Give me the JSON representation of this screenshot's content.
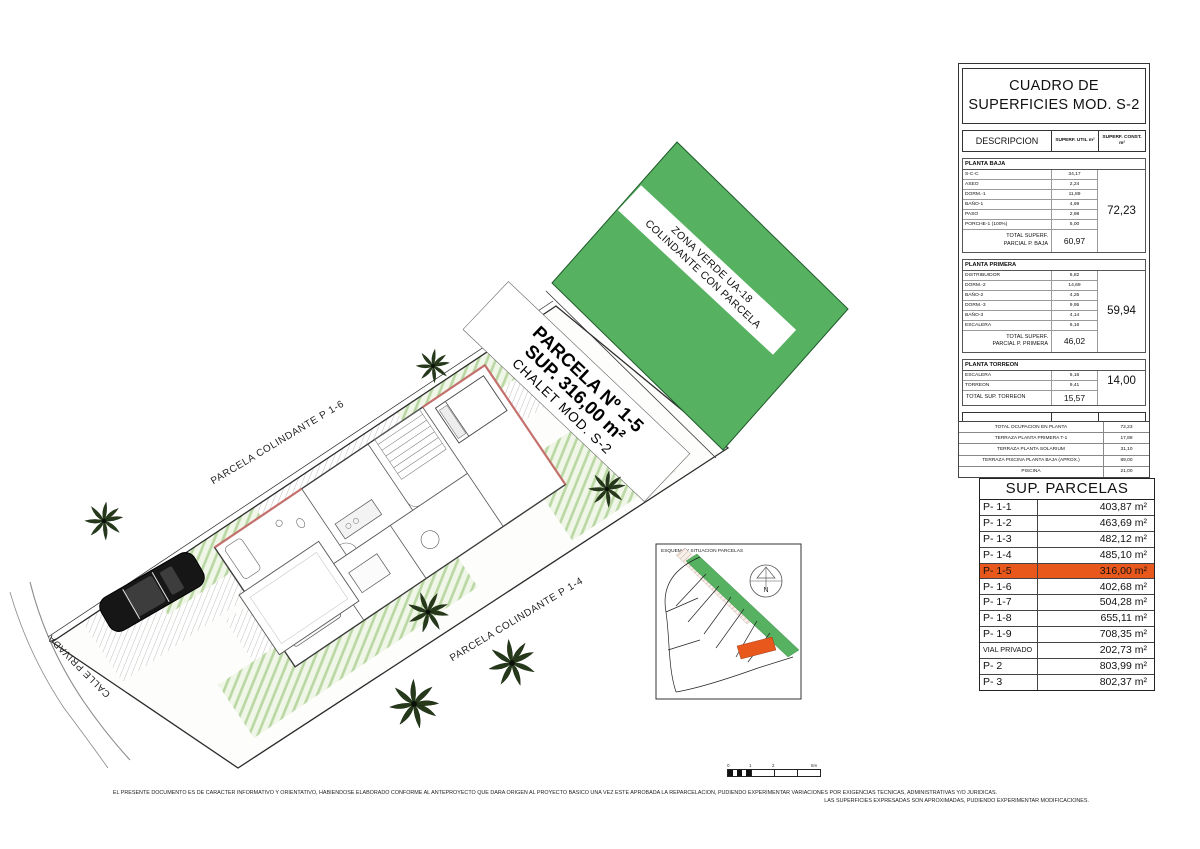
{
  "colors": {
    "green": "#56b161",
    "orange": "#e8571c",
    "lawn_stripe": "#b9d7a2",
    "hatch_gray": "#9c9c95"
  },
  "cuadro": {
    "title": "CUADRO DE SUPERFICIES MOD. S-2",
    "headers": {
      "desc": "DESCRIPCION",
      "util": "SUPERF. UTIL m²",
      "const": "SUPERF. CONST. m²"
    },
    "sections": [
      {
        "name": "PLANTA BAJA",
        "rows": [
          [
            "S-C-C",
            "34,17"
          ],
          [
            "ASEO",
            "2,24"
          ],
          [
            "DORM.-1",
            "11,89"
          ],
          [
            "BAÑO-1",
            "4,69"
          ],
          [
            "PASO",
            "2,98"
          ],
          [
            "PORCHE-1 (100%)",
            "5,00"
          ]
        ],
        "total_label": "TOTAL SUPERF.\nPARCIAL P. BAJA",
        "total": "60,97",
        "const_total": "72,23",
        "const_span": "all",
        "two_line": true
      },
      {
        "name": "PLANTA PRIMERA",
        "rows": [
          [
            "DISTRIBUIDOR",
            "6,82"
          ],
          [
            "DORM.-2",
            "14,69"
          ],
          [
            "BAÑO-2",
            "4,26"
          ],
          [
            "DORM.-3",
            "9,95"
          ],
          [
            "BAÑO-3",
            "4,14"
          ],
          [
            "ESCALERA",
            "6,16"
          ]
        ],
        "total_label": "TOTAL SUPERF.\nPARCIAL P. PRIMERA",
        "total": "46,02",
        "const_total": "59,94",
        "const_span": "all",
        "two_line": true
      },
      {
        "name": "PLANTA TORREON",
        "rows": [
          [
            "ESCALERA",
            "6,16"
          ],
          [
            "TORREON",
            "9,41"
          ]
        ],
        "total_label": "TOTAL SUP. TORREON",
        "total": "15,57",
        "const_total": "14,00",
        "const_span": "rows",
        "two_line": false
      }
    ],
    "grand_total": {
      "label": "TOTAL SUPERFICIES",
      "util": "122,56",
      "const": "146,17"
    },
    "extras": [
      [
        "TOTAL OCUPACION EN PLANTA",
        "72,23"
      ],
      [
        "TERRAZA PLANTA PRIMERA T-1",
        "17,88"
      ],
      [
        "TERRAZA PLANTA SOLARIUM",
        "31,10"
      ],
      [
        "TERRAZA PISCINA PLANTA BAJA (APROX.)",
        "89,00"
      ],
      [
        "PISCINA",
        "21,00"
      ]
    ]
  },
  "parcelas": {
    "title": "SUP. PARCELAS",
    "rows": [
      {
        "label": "P- 1-1",
        "value": "403,87 m²"
      },
      {
        "label": "P- 1-2",
        "value": "463,69 m²"
      },
      {
        "label": "P- 1-3",
        "value": "482,12 m²"
      },
      {
        "label": "P- 1-4",
        "value": "485,10 m²"
      },
      {
        "label": "P- 1-5",
        "value": "316,00 m²",
        "highlight": true
      },
      {
        "label": "P- 1-6",
        "value": "402,68 m²"
      },
      {
        "label": "P- 1-7",
        "value": "504,28 m²"
      },
      {
        "label": "P- 1-8",
        "value": "655,11 m²"
      },
      {
        "label": "P- 1-9",
        "value": "708,35 m²"
      },
      {
        "label": "VIAL PRIVADO",
        "value": "202,73 m²",
        "small": true
      },
      {
        "label": "P- 2",
        "value": "803,99 m²"
      },
      {
        "label": "P- 3",
        "value": "802,37 m²"
      }
    ]
  },
  "plan": {
    "zona_verde_line1": "ZONA VERDE UA-18",
    "zona_verde_line2": "COLINDANTE CON PARCELA",
    "parcela_line1": "PARCELA Nº 1-5",
    "parcela_line2": "SUP. 316,00 m²",
    "parcela_line3": "CHALET MOD. S-2",
    "neighbor_left": "PARCELA COLINDANTE P 1-6",
    "neighbor_bottom": "PARCELA COLINDANTE P 1-4",
    "street": "CALLE PRIVADA"
  },
  "inset": {
    "title": "ESQUEMA Y SITUACION PARCELAS",
    "north_label": "N"
  },
  "footer": {
    "line1": "EL PRESENTE DOCUMENTO ES DE CARACTER INFORMATIVO Y ORIENTATIVO, HABIENDOSE ELABORADO CONFORME AL ANTEPROYECTO QUE DARA ORIGEN AL PROYECTO BASICO UNA VEZ ESTE APROBADA LA REPARCELACION, PUDIENDO EXPERIMENTAR VARIACIONES POR EXIGENCIAS TECNICAS, ADMINISTRATIVAS Y/O JURIDICAS.",
    "line2": "LAS SUPERFICIES EXPRESADAS SON APROXIMADAS, PUDIENDO EXPERIMENTAR MODIFICACIONES.",
    "scale": [
      "0",
      "1",
      "2",
      "5m"
    ]
  }
}
